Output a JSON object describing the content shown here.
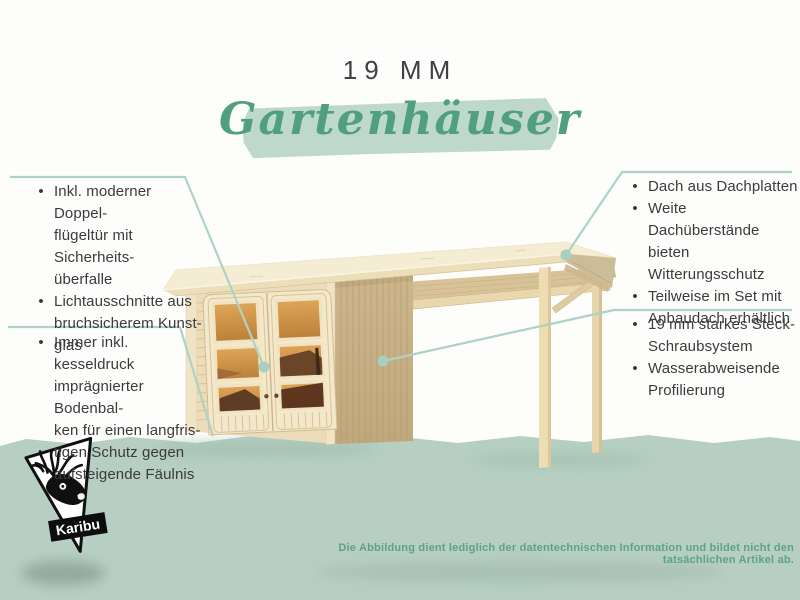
{
  "header": {
    "thickness": "19 MM",
    "title": "Gartenhäuser"
  },
  "bullet_glyph": "•",
  "callouts": {
    "top_left": {
      "items": [
        {
          "text": "Inkl. moderner Doppel-\nflügeltür mit Sicherheits-\nüberfalle"
        },
        {
          "text": "Lichtausschnitte aus\nbruchsicherem Kunst-\nglas"
        }
      ]
    },
    "bottom_left": {
      "items": [
        {
          "text": "Immer inkl. kesseldruck\nimprägnierter Bodenbal-\nken für einen langfris-\ntigen Schutz gegen\naufsteigende Fäulnis"
        }
      ]
    },
    "top_right": {
      "items": [
        {
          "text": "Dach aus Dachplatten"
        },
        {
          "text": "Weite Dachüberstände\nbieten Witterungsschutz"
        },
        {
          "text": "Teilweise im Set mit\nAnbaudach erhältlich"
        }
      ]
    },
    "bottom_right": {
      "items": [
        {
          "text": "19 mm starkes Steck-\nSchraubsystem"
        },
        {
          "text": "Wasserabweisende\nProfilierung"
        }
      ]
    }
  },
  "logo": {
    "brand": "Karibu"
  },
  "footer": {
    "disclaimer": "Die Abbildung dient lediglich der datentechnischen Information und bildet nicht den tatsächlichen Artikel ab."
  },
  "colors": {
    "accent_green": "#4f9f80",
    "brush_green": "#bed9cc",
    "band_green": "#b6cfc2",
    "callout_line": "#aed2c5",
    "text_dark": "#3b3b3b",
    "disclaimer_green": "#5da287",
    "wood_front": "#ecdcba",
    "wood_side": "#c9b288",
    "glass_orange": "#cf9045"
  }
}
